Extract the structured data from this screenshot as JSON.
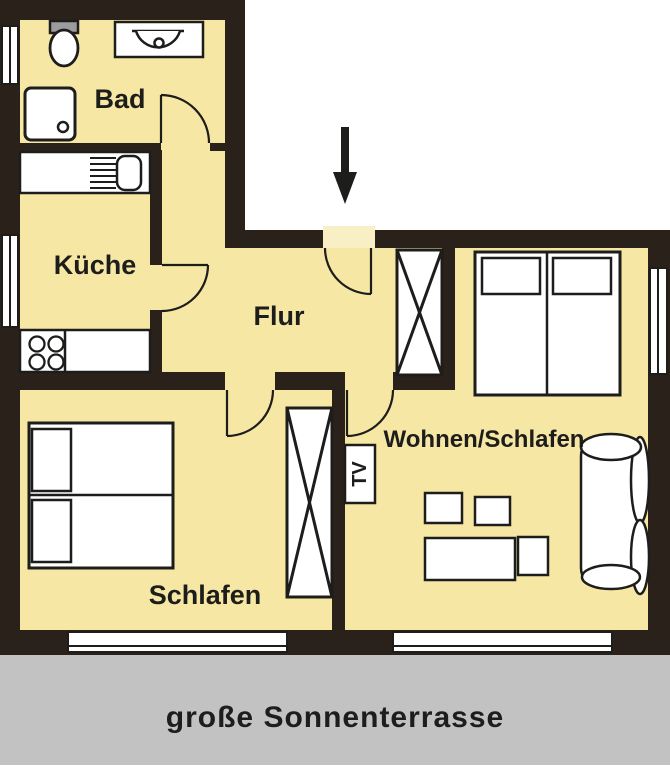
{
  "labels": {
    "bad": "Bad",
    "kueche": "Küche",
    "flur": "Flur",
    "schlafen": "Schlafen",
    "wohnen_schlafen": "Wohnen/Schlafen",
    "tv": "TV",
    "terrace": "große Sonnenterrasse"
  },
  "colors": {
    "floor": "#f7e7a4",
    "wall": "#2a211b",
    "line": "#1d1d1b",
    "terrace": "#c3c2c2",
    "threshold": "#f9efc5",
    "cistern": "#9c9c9c",
    "furniture_fill": "#ffffff"
  }
}
